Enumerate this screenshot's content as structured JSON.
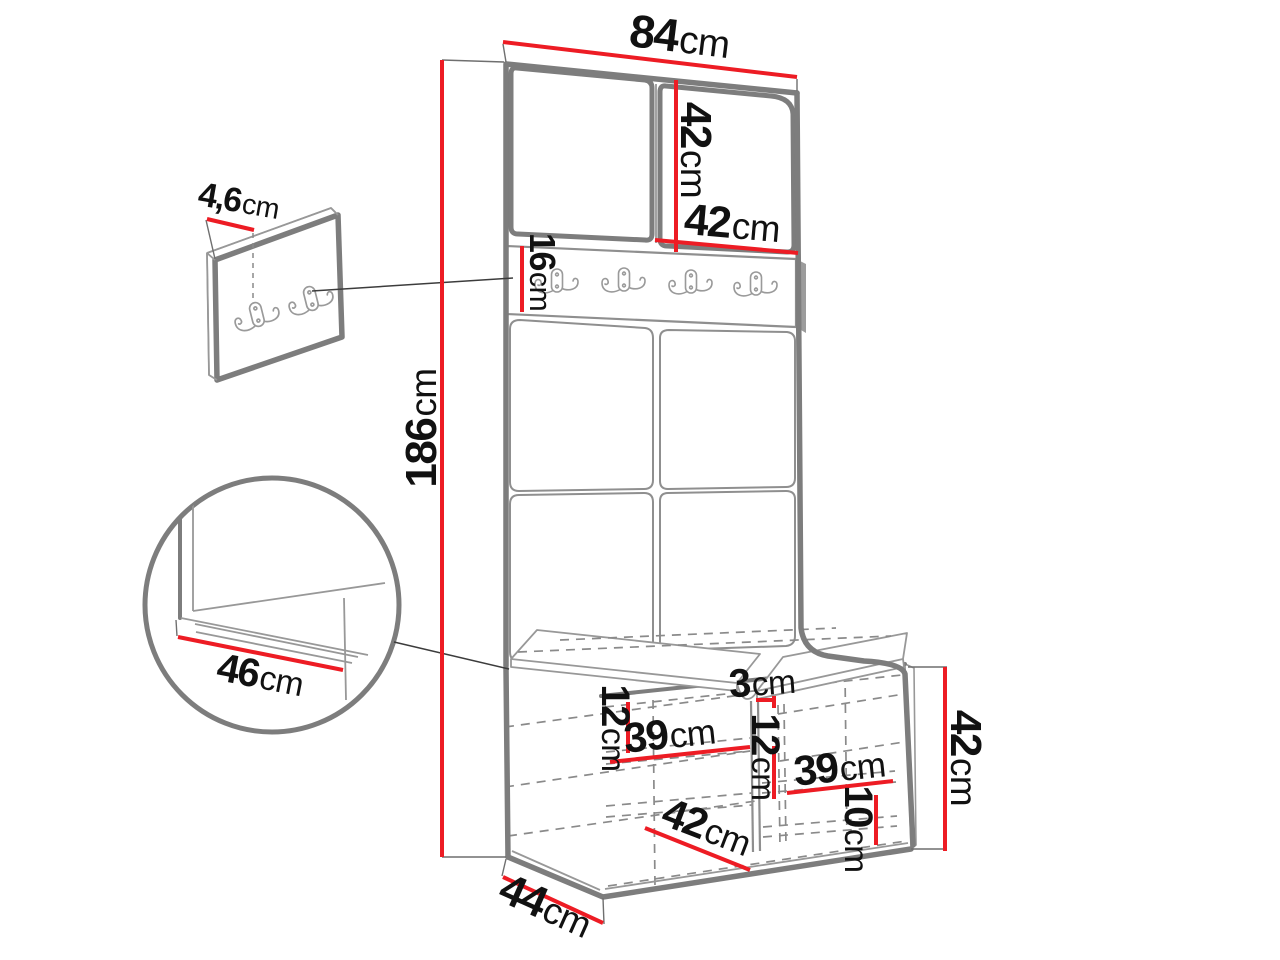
{
  "title": "Hallway furniture set dimension diagram",
  "colors": {
    "red": "#ed1c24",
    "outline_thick": "#7d7d7d",
    "outline_thin": "#989898",
    "dashed_line": "#8a8a8a",
    "text": "#111111",
    "connector": "#3c3c3c",
    "background": "#ffffff"
  },
  "dims": {
    "width_top": {
      "num": "84",
      "unit": "cm"
    },
    "upper_cabinet_height": {
      "num": "42",
      "unit": "cm"
    },
    "upper_door_width": {
      "num": "42",
      "unit": "cm"
    },
    "hook_rail_height": {
      "num": "16",
      "unit": "cm"
    },
    "total_height": {
      "num": "186",
      "unit": "cm"
    },
    "wall_panel_thickness": {
      "num": "4,6",
      "unit": "cm"
    },
    "seat_depth_detail": {
      "num": "46",
      "unit": "cm"
    },
    "divider_thickness": {
      "num": "3",
      "unit": "cm"
    },
    "left_top_offset": {
      "num": "12",
      "unit": "cm"
    },
    "left_compartment_width": {
      "num": "39",
      "unit": "cm"
    },
    "right_top_offset": {
      "num": "12",
      "unit": "cm"
    },
    "right_compartment_width": {
      "num": "39",
      "unit": "cm"
    },
    "right_bottom_offset": {
      "num": "10",
      "unit": "cm"
    },
    "bench_inner_depth": {
      "num": "42",
      "unit": "cm"
    },
    "bench_height": {
      "num": "42",
      "unit": "cm"
    },
    "bench_depth": {
      "num": "44",
      "unit": "cm"
    }
  }
}
